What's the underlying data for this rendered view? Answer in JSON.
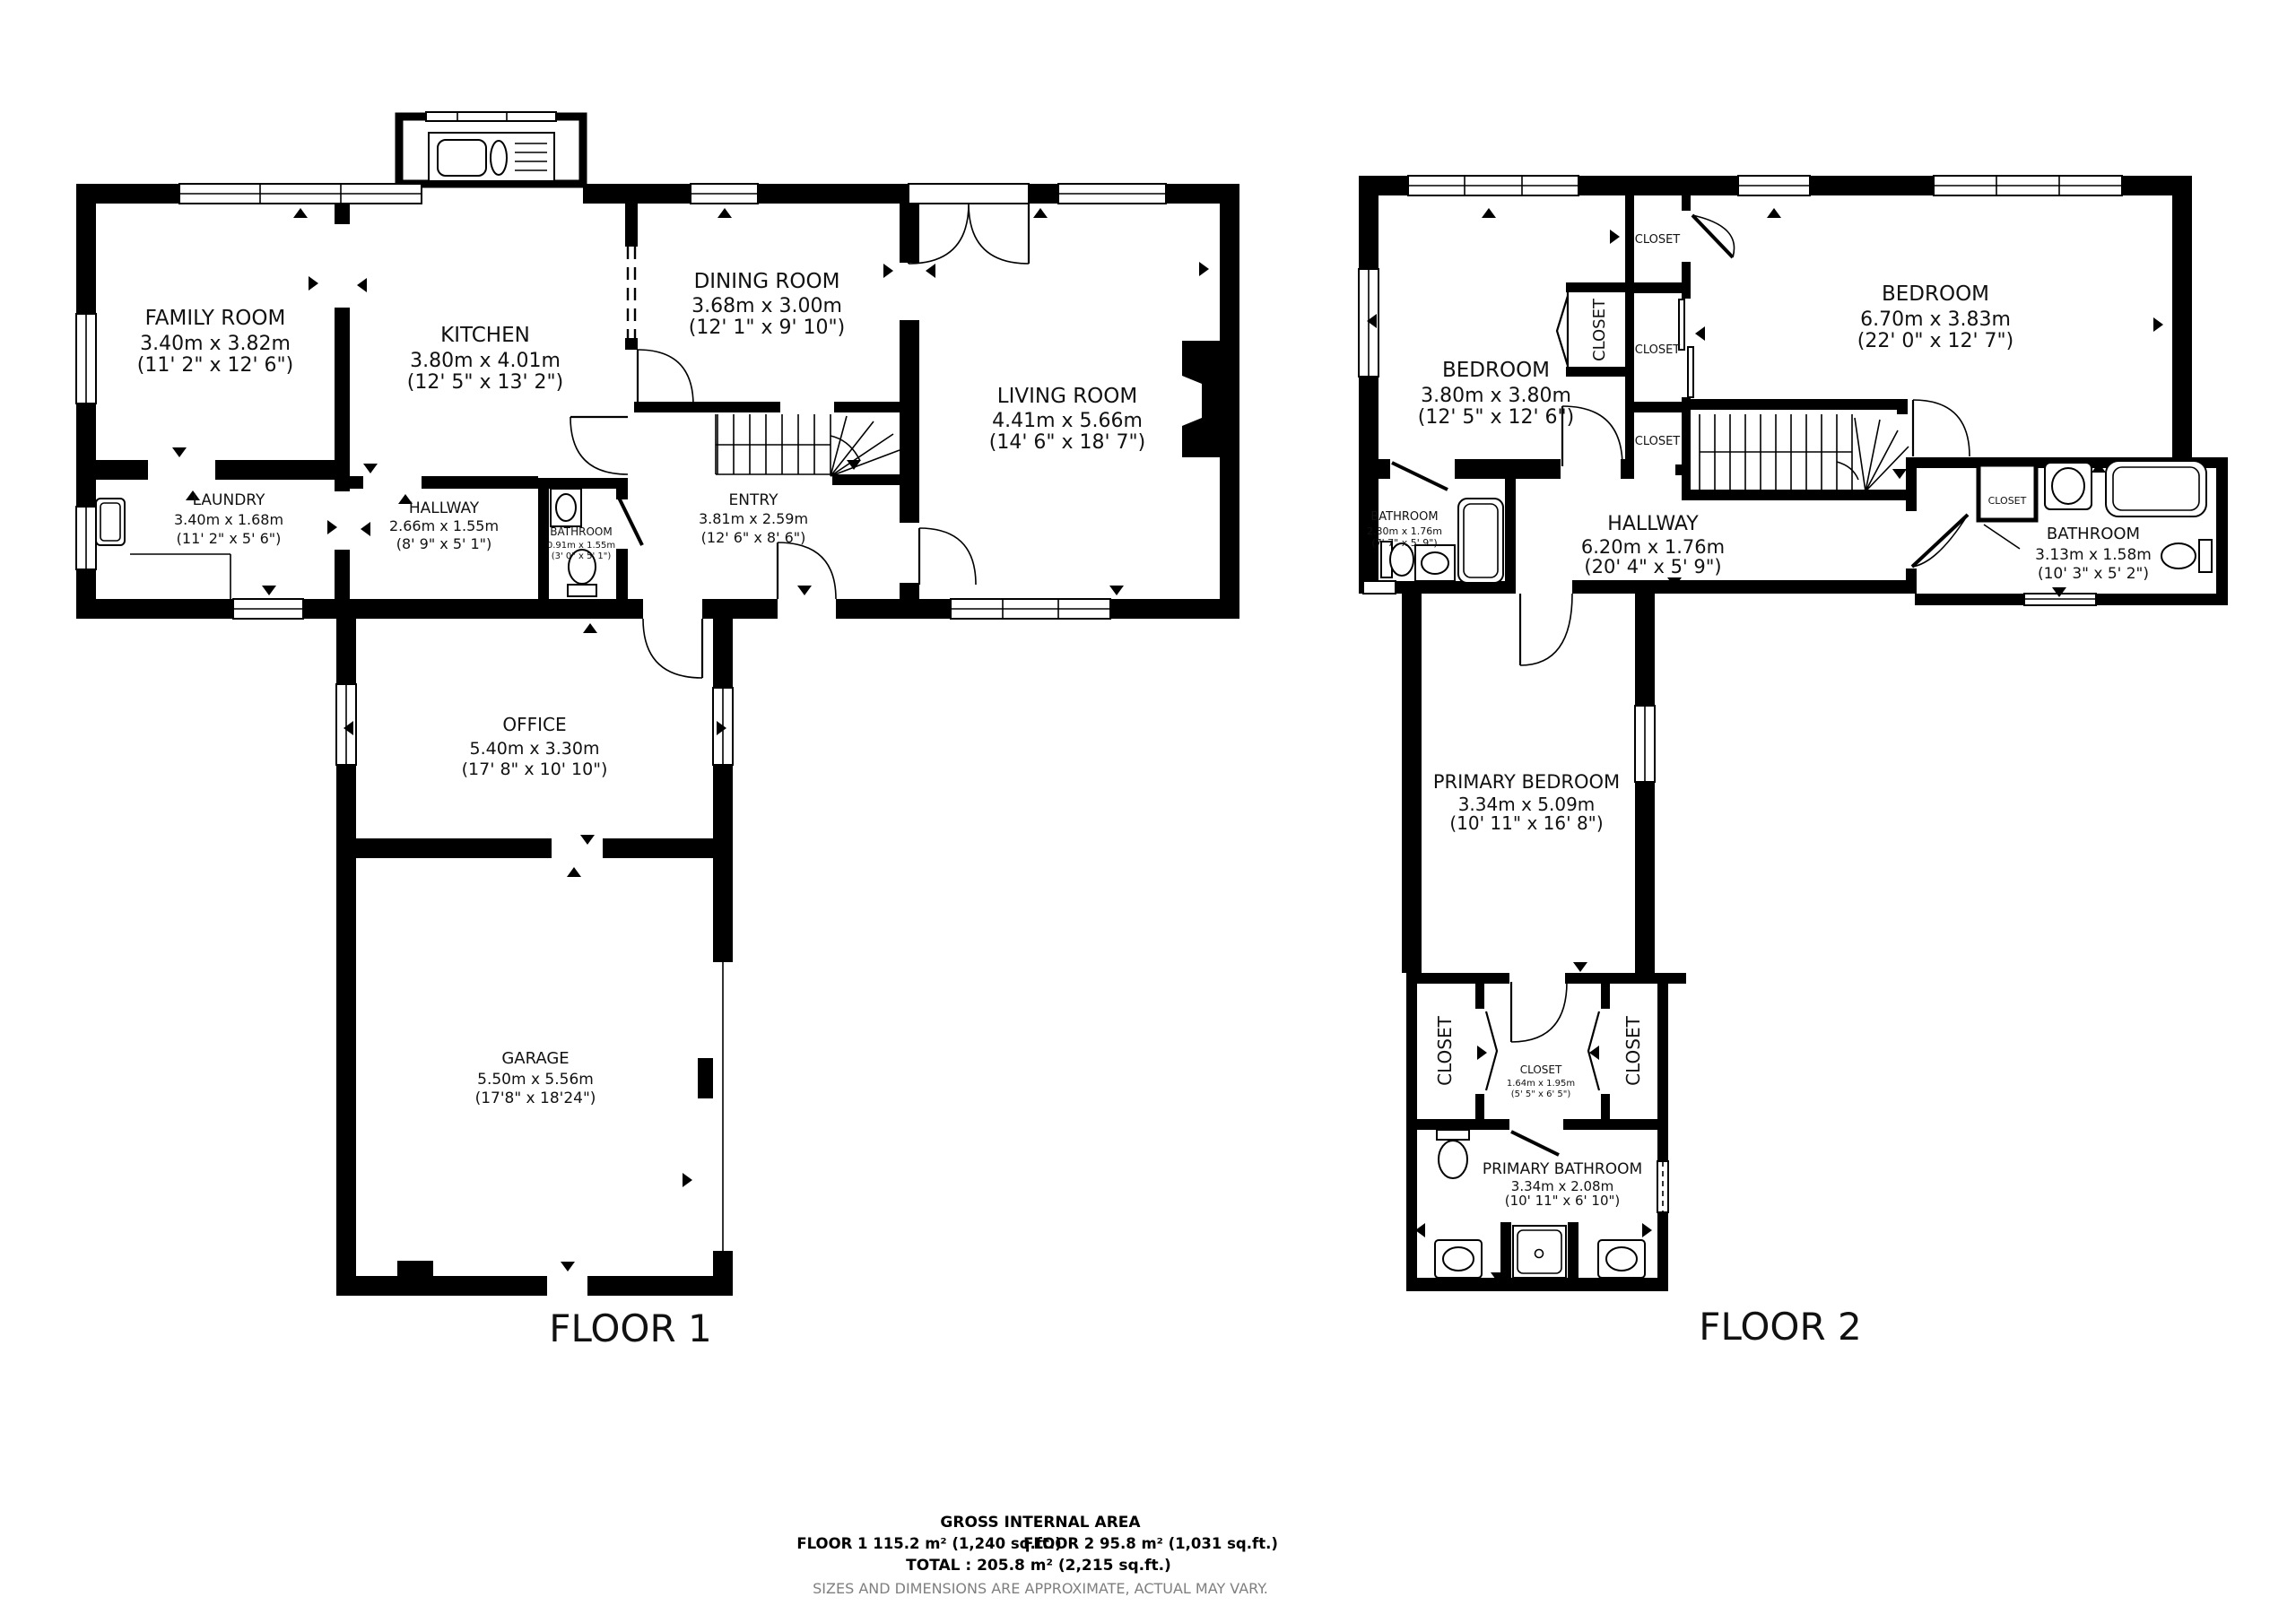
{
  "page": {
    "background": "#ffffff",
    "wall_color": "#000000",
    "note_color": "#7f7f7f"
  },
  "floor1": {
    "label": "FLOOR 1",
    "rooms": {
      "family_room": {
        "name": "FAMILY ROOM",
        "metric": "3.40m x 3.82m",
        "imperial": "(11' 2\" x 12' 6\")"
      },
      "kitchen": {
        "name": "KITCHEN",
        "metric": "3.80m x 4.01m",
        "imperial": "(12' 5\" x 13' 2\")"
      },
      "dining_room": {
        "name": "DINING ROOM",
        "metric": "3.68m x 3.00m",
        "imperial": "(12' 1\" x 9' 10\")"
      },
      "living_room": {
        "name": "LIVING ROOM",
        "metric": "4.41m x 5.66m",
        "imperial": "(14' 6\" x 18' 7\")"
      },
      "laundry": {
        "name": "LAUNDRY",
        "metric": "3.40m x 1.68m",
        "imperial": "(11' 2\" x 5' 6\")"
      },
      "hallway": {
        "name": "HALLWAY",
        "metric": "2.66m x 1.55m",
        "imperial": "(8' 9\" x 5' 1\")"
      },
      "bathroom": {
        "name": "BATHROOM",
        "metric": "0.91m x 1.55m",
        "imperial": "(3' 0\" x 5' 1\")"
      },
      "entry": {
        "name": "ENTRY",
        "metric": "3.81m x 2.59m",
        "imperial": "(12' 6\" x 8' 6\")"
      },
      "office": {
        "name": "OFFICE",
        "metric": "5.40m x 3.30m",
        "imperial": "(17' 8\" x 10' 10\")"
      },
      "garage": {
        "name": "GARAGE",
        "metric": "5.50m x 5.56m",
        "imperial": "(17'8\" x 18'24\")"
      }
    }
  },
  "floor2": {
    "label": "FLOOR 2",
    "closet_label": "CLOSET",
    "rooms": {
      "bedroom_left": {
        "name": "BEDROOM",
        "metric": "3.80m x 3.80m",
        "imperial": "(12' 5\" x 12' 6\")"
      },
      "bedroom_right": {
        "name": "BEDROOM",
        "metric": "6.70m x 3.83m",
        "imperial": "(22' 0\" x 12' 7\")"
      },
      "bathroom_left": {
        "name": "BATHROOM",
        "metric": "2.30m x 1.76m",
        "imperial": "(7' 7\" x 5' 9\")"
      },
      "hallway": {
        "name": "HALLWAY",
        "metric": "6.20m x 1.76m",
        "imperial": "(20' 4\" x 5' 9\")"
      },
      "bathroom_right": {
        "name": "BATHROOM",
        "metric": "3.13m x 1.58m",
        "imperial": "(10' 3\" x 5' 2\")"
      },
      "primary_bedroom": {
        "name": "PRIMARY BEDROOM",
        "metric": "3.34m x 5.09m",
        "imperial": "(10' 11\" x 16' 8\")"
      },
      "closet_middle": {
        "name": "CLOSET",
        "metric": "1.64m x 1.95m",
        "imperial": "(5' 5\" x 6' 5\")"
      },
      "primary_bathroom": {
        "name": "PRIMARY BATHROOM",
        "metric": "3.34m x 2.08m",
        "imperial": "(10' 11\" x 6' 10\")"
      }
    }
  },
  "footer": {
    "title": "GROSS INTERNAL AREA",
    "floor1_area": "FLOOR 1 115.2 m² (1,240 sq.ft.)",
    "floor2_area": "FLOOR 2 95.8 m² (1,031 sq.ft.)",
    "total": "TOTAL :  205.8 m² (2,215 sq.ft.)",
    "note": "SIZES AND DIMENSIONS ARE APPROXIMATE, ACTUAL MAY VARY."
  }
}
